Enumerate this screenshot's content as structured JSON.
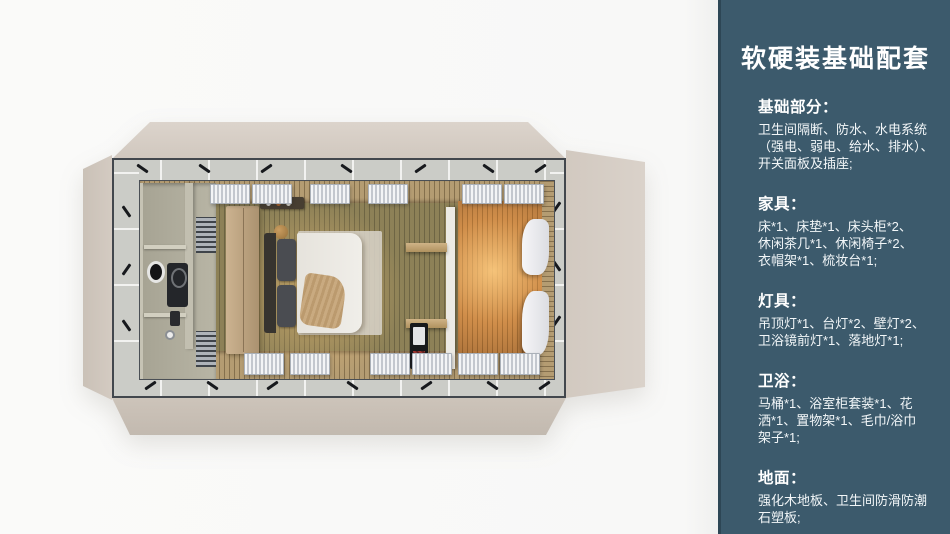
{
  "panel": {
    "title": "软硬装基础配套",
    "accent_color": "#3c5a6c",
    "text_color": "#ffffff",
    "sections": [
      {
        "heading": "基础部分：",
        "body": "卫生间隔断、防水、水电系统\n（强电、弱电、给水、排水）、\n开关面板及插座;"
      },
      {
        "heading": "家具：",
        "body": "床*1、床垫*1、床头柜*2、\n休闲茶几*1、休闲椅子*2、\n衣帽架*1、梳妆台*1;"
      },
      {
        "heading": "灯具：",
        "body": "吊顶灯*1、台灯*2、壁灯*2、\n卫浴镜前灯*1、落地灯*1;"
      },
      {
        "heading": "卫浴：",
        "body": "马桶*1、浴室柜套装*1、花\n洒*1、置物架*1、毛巾/浴巾\n架子*1;"
      },
      {
        "heading": "地面：",
        "body": "强化木地板、卫生间防滑防潮\n石塑板;"
      }
    ]
  },
  "render": {
    "type": "top-down interior render",
    "colors": {
      "background": "#f8f8f7",
      "flap_beige": "#d2c9c0",
      "frame_dark": "#42474d",
      "deck_gray": "#cbccc7",
      "floor_wood_olive": "#8d8157",
      "lounge_wood_orange": "#c08448",
      "warm_glow": "#f8c478",
      "bathroom_sage": "#b0ad9d",
      "wardrobe_wood": "#c2a985",
      "bed_linen": "#edebe5",
      "throw_knit": "#c3a275",
      "curtain_white": "#f3f4f6"
    }
  }
}
